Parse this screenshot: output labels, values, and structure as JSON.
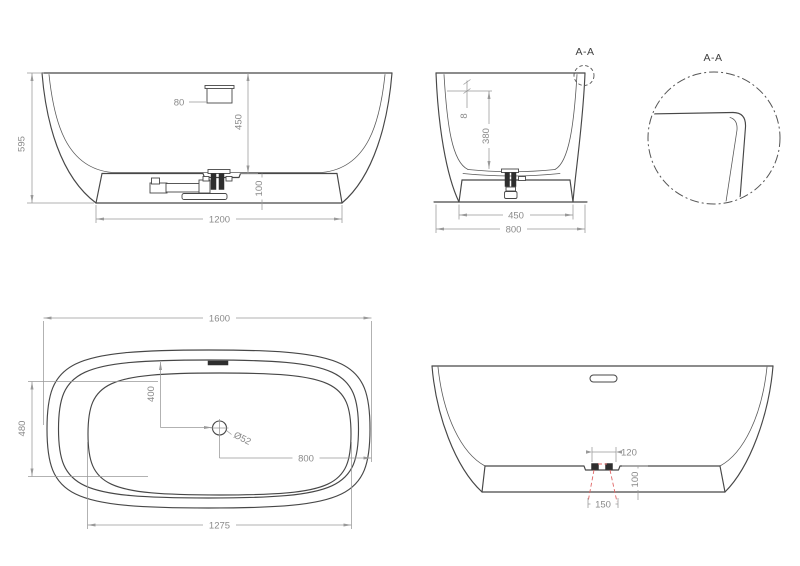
{
  "drawing": {
    "type": "bathtub technical drawing",
    "colors": {
      "object_line": "#474747",
      "dimension_line": "#999999",
      "dimension_text": "#8a8a8a",
      "highlight_red": "#e06666",
      "background": "#ffffff"
    },
    "views": {
      "front_elevation": {
        "dims": {
          "overall_height": "595",
          "overflow_width": "80",
          "rim_to_floor": "450",
          "plinth_height": "100",
          "plinth_width": "1200"
        }
      },
      "end_section": {
        "section_label": "A-A",
        "dims": {
          "rim_lip": "8",
          "interior_depth": "380",
          "plinth_width": "450",
          "overall_width": "800"
        }
      },
      "rim_detail": {
        "label": "A-A"
      },
      "plan": {
        "dims": {
          "overall_length": "1600",
          "basin_width": "480",
          "drain_offset": "400",
          "drain_diameter": "Ø52",
          "drain_to_end": "800",
          "basin_length": "1275"
        }
      },
      "rear_elevation": {
        "dims": {
          "drain_recess_width": "120",
          "plinth_height": "100",
          "drain_clearance": "150"
        }
      }
    }
  }
}
